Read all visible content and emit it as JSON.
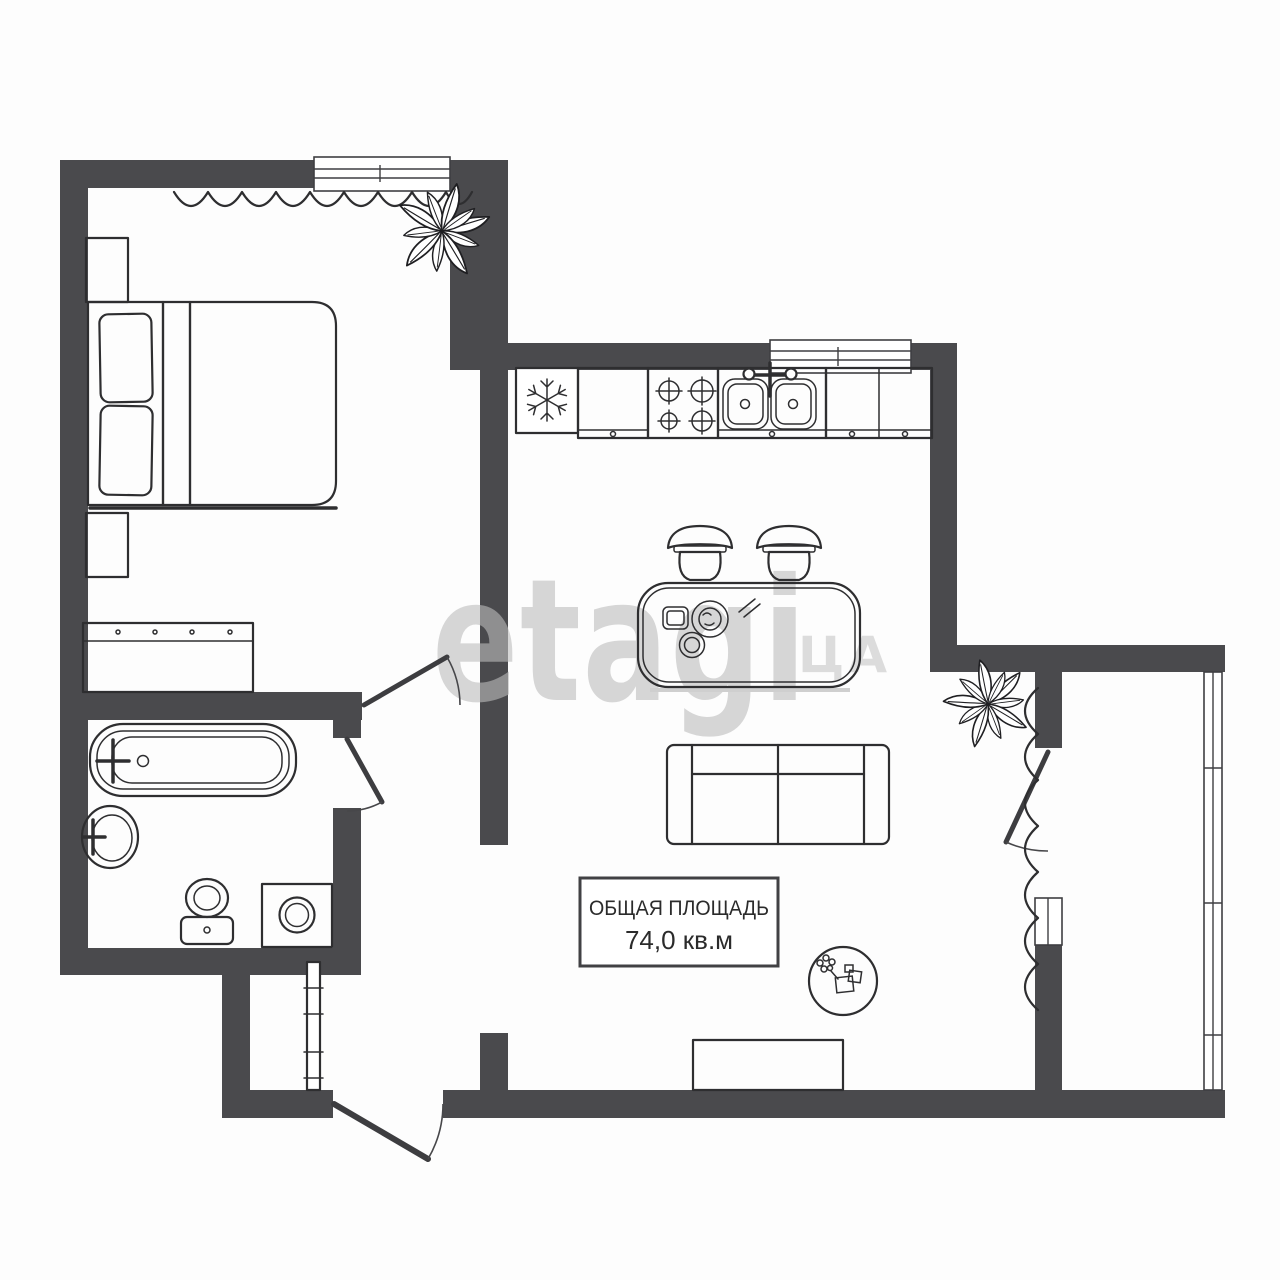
{
  "colors": {
    "wall": "#4a4a4d",
    "line": "#2e2e30",
    "watermark": "#bdbdbd",
    "label_text": "#2b2b2b",
    "label_border": "#414144"
  },
  "watermark": {
    "main": "etagi",
    "suffix": "ЦА"
  },
  "label_box": {
    "line1": "ОБЩАЯ ПЛОЩАДЬ",
    "line2": "74,0 кв.м"
  },
  "legend": {
    "icons": {
      "fridge": "snowflake-icon",
      "stove": "burner-icon",
      "kitchen_sink": "double-basin-faucet-icon",
      "bath": "bathtub-icon",
      "wc": "toilet-icon",
      "laundry": "washing-machine-icon",
      "decor": "plant-icon",
      "windows": "window-icon",
      "doors": "door-arc-icon",
      "curtains": "curtain-icon"
    }
  }
}
